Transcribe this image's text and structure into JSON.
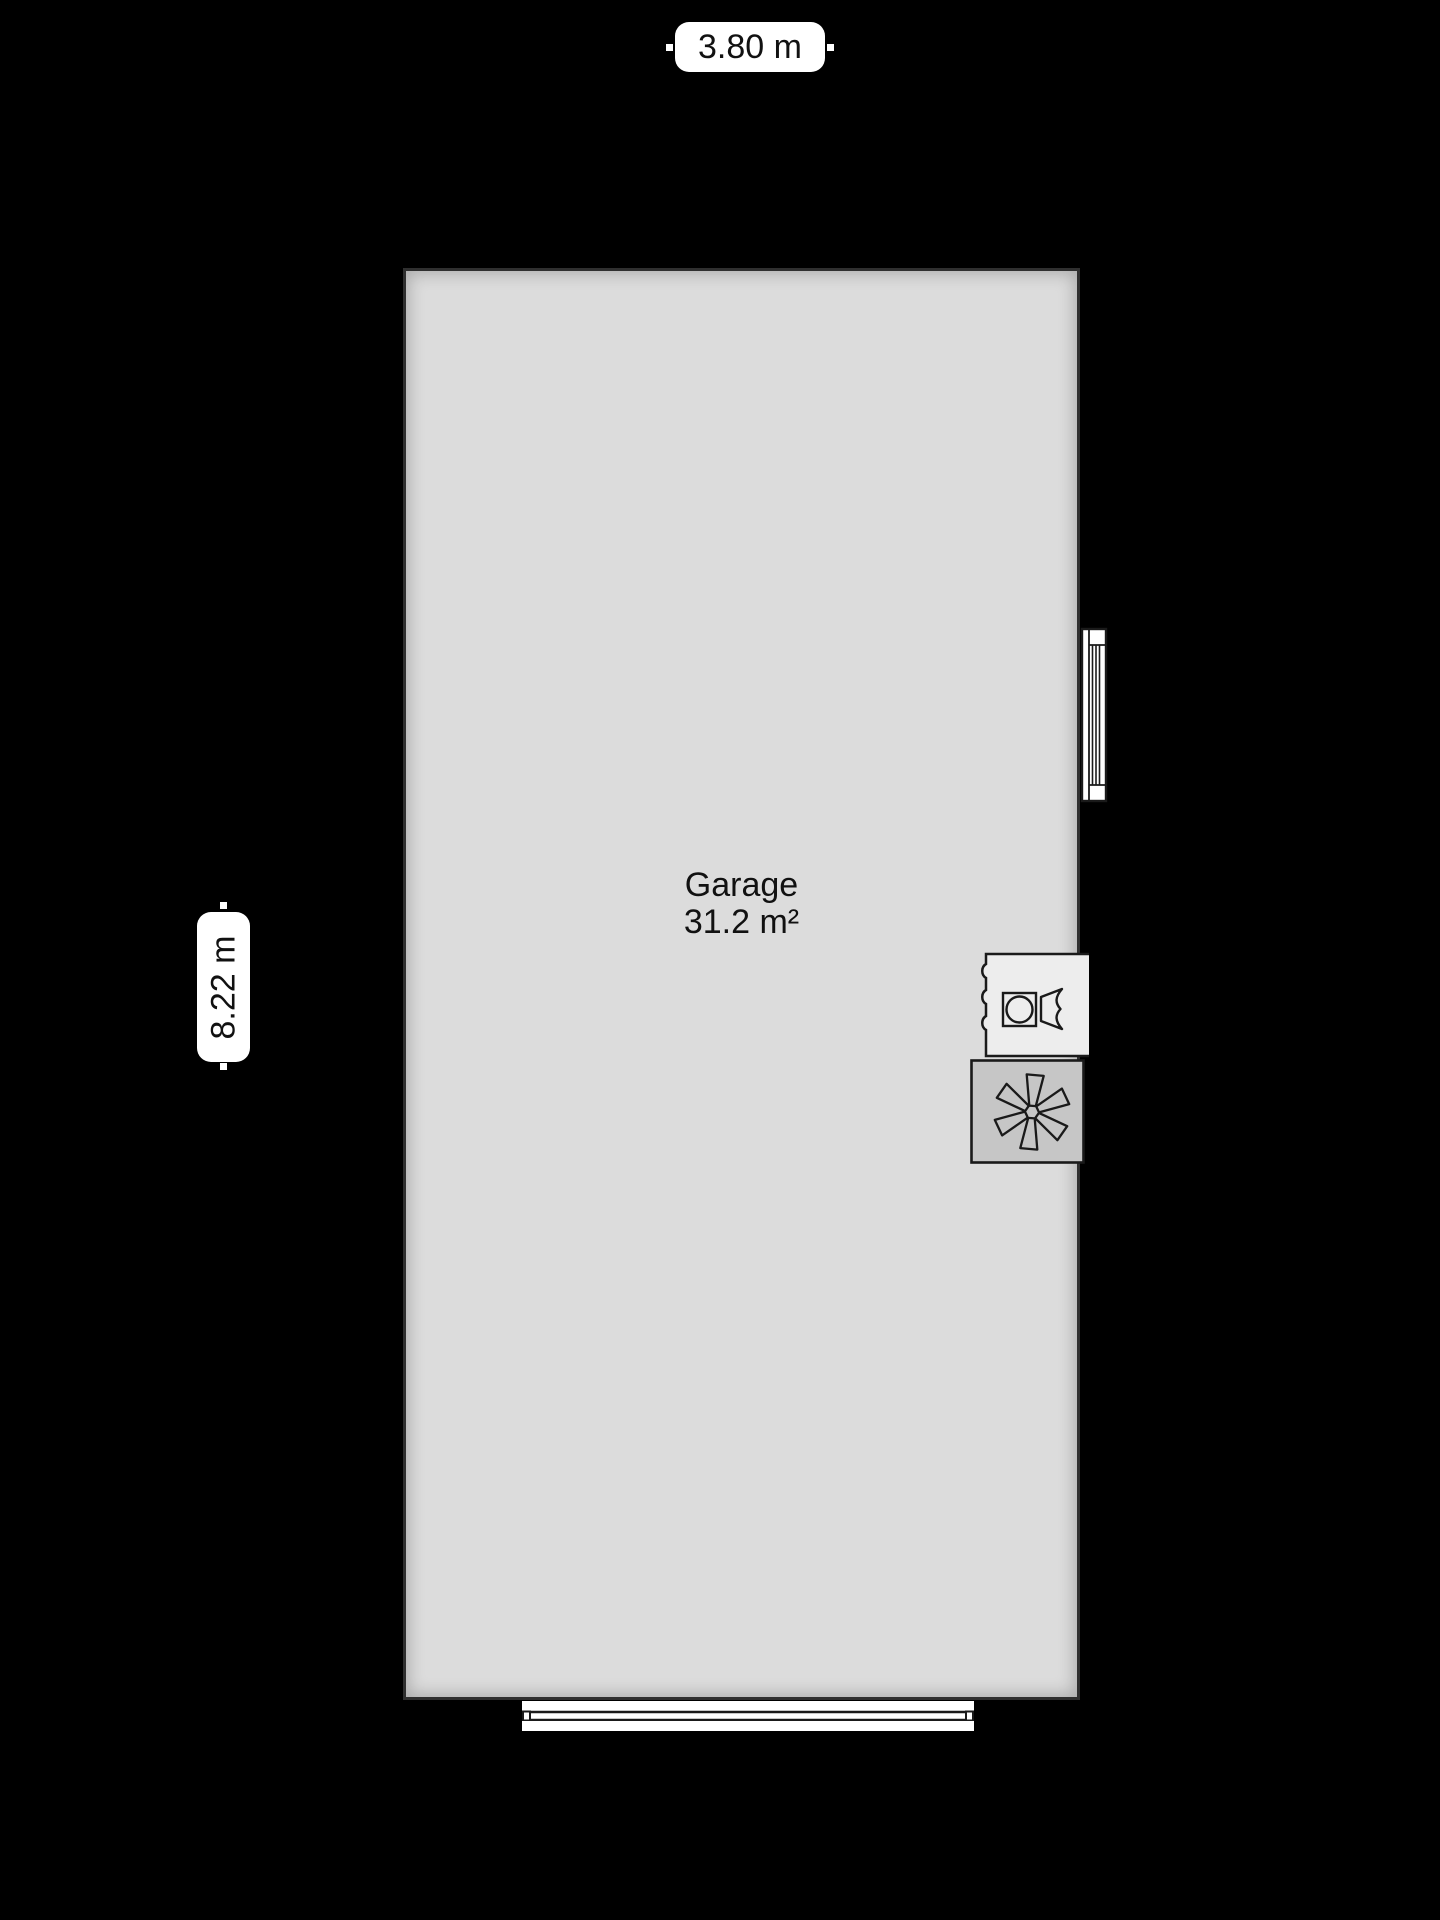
{
  "plan": {
    "room": {
      "name": "Garage",
      "area": "31.2 m²"
    },
    "dimensions": {
      "width_label": "3.80 m",
      "height_label": "8.22 m"
    },
    "icons": {
      "window": "window-symbol",
      "garage_door": "garage-door-symbol",
      "washer": "washing-machine-icon",
      "fan": "ventilation-fan-icon"
    },
    "colors": {
      "background": "#000000",
      "room_fill": "#dcdcdc",
      "wall_line": "#2f2f2f",
      "pill_bg": "#ffffff",
      "text": "#111111",
      "door_fill": "#ffffff",
      "washer_fill": "#ededed",
      "fan_fill": "#c6c6c6",
      "icon_stroke": "#1a1a1a"
    }
  }
}
